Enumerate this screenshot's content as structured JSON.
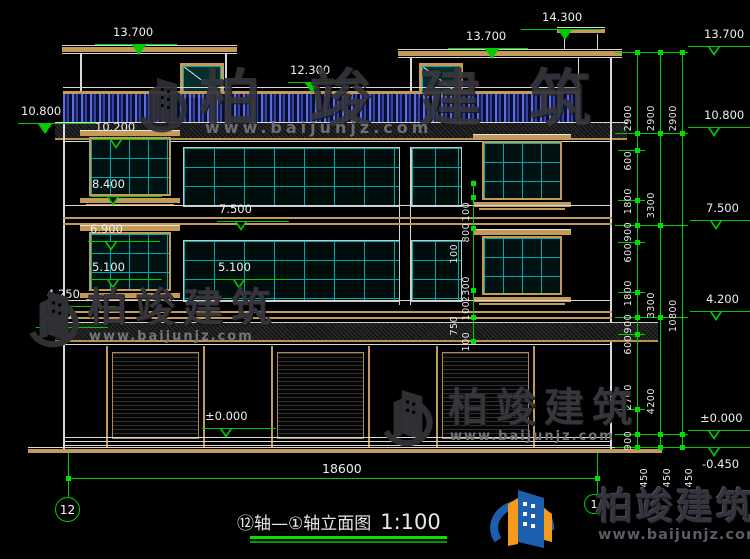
{
  "drawing": {
    "title": "⑫轴—①轴立面图",
    "scale": "1:100",
    "bottom_width_dim": "18600",
    "axis_bubble_left": "12",
    "axis_bubble_right": "1"
  },
  "elevations": {
    "left_roof": "13.700",
    "mid_roof": "13.700",
    "chimney_top": "14.300",
    "parapet": "12.300",
    "cornice_left": "10.800",
    "win_head_3f": "10.200",
    "win_sill_3f": "8.400",
    "floor_3f": "7.500",
    "win_head_2f": "6.900",
    "win_sill_2f_left": "5.100",
    "win_sill_2f_mid": "5.100",
    "canopy_top": "4.250",
    "canopy_bottom": "3.600",
    "ground_floor": "±0.000",
    "right_roof": "13.700",
    "right_cornice": "10.800",
    "right_floor3": "7.500",
    "right_floor2": "4.200",
    "right_ground": "±0.000",
    "right_site": "-0.450"
  },
  "dims": {
    "right_inner": [
      "2900",
      "600",
      "1800",
      "900",
      "600",
      "1800",
      "900",
      "600",
      "2700",
      "900",
      "450"
    ],
    "right_middle": [
      "2900",
      "3300",
      "3300",
      "4200",
      "450"
    ],
    "right_outer": [
      "2900",
      "10800",
      "450"
    ],
    "center": [
      "100",
      "800",
      "100",
      "2300",
      "100",
      "750",
      "100"
    ]
  },
  "brand": {
    "name": "柏竣建筑",
    "site": "www.baijunjz.com"
  },
  "colors": {
    "dim_green": "#00cc00",
    "frame_tan": "#c49a58",
    "glass_teal": "#00a8a8",
    "baluster_blue": "#4a63e0"
  }
}
